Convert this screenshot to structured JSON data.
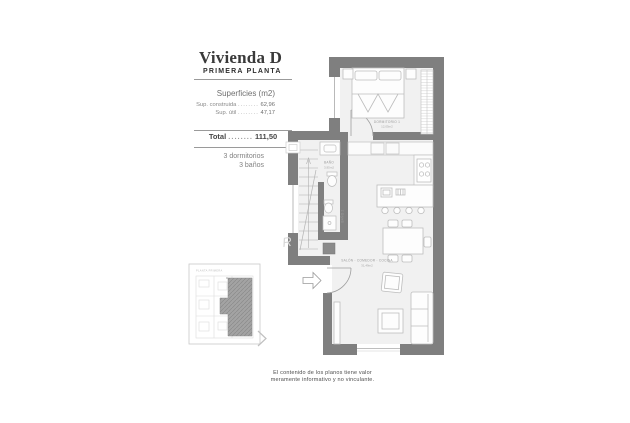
{
  "colors": {
    "wall": "#7f7f7f",
    "floor": "#f1f1f1",
    "title_text": "#3a3a3a",
    "body_text": "#8a8a8a",
    "plan_label": "#9b9b9b"
  },
  "panel": {
    "title": "Vivienda D",
    "subtitle": "PRIMERA PLANTA",
    "surfaces_heading": "Superficies (m2)",
    "surface_rows": [
      {
        "label": "Sup. construida",
        "leader": "........",
        "value": "62,96"
      },
      {
        "label": "Sup. útil",
        "leader": "........",
        "value": "47,17"
      }
    ],
    "total": {
      "label": "Total",
      "leader": "........",
      "value": "111,50"
    },
    "features": [
      "3 dormitorios",
      "3 baños"
    ]
  },
  "plan": {
    "bedroom": {
      "name": "DORMITORIO 1",
      "area": "12,05m2"
    },
    "bath": {
      "name": "BAÑO",
      "area": "3,95m2"
    },
    "bath2": {
      "name": "BAÑO 2"
    },
    "living": {
      "name": "SALÓN - COMEDOR - COCINA",
      "area": "31,49m2"
    },
    "watermark": "R"
  },
  "keyplan": {
    "caption": "PLANTA PRIMERA"
  },
  "disclaimer": {
    "line1": "El contenido de los planos tiene valor",
    "line2": "meramente informativo y no vinculante."
  }
}
